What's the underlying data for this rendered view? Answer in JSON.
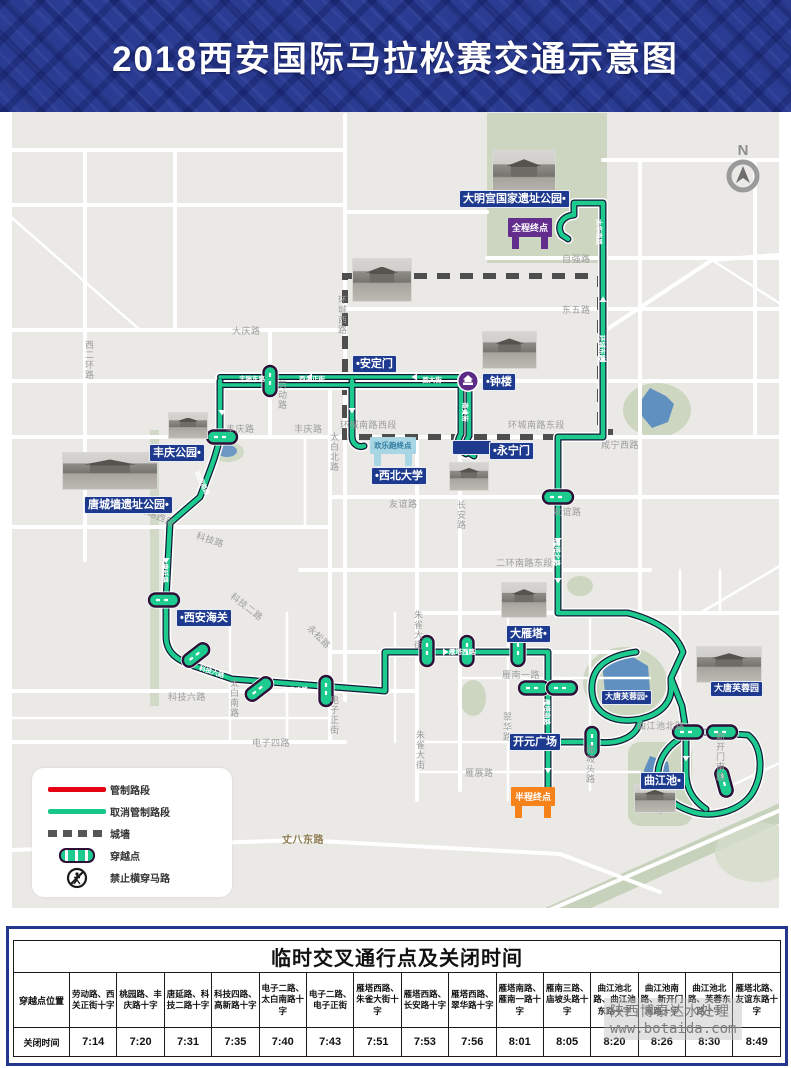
{
  "header": {
    "title": "2018西安国际马拉松赛交通示意图"
  },
  "north_label": "N",
  "map": {
    "place_labels": [
      {
        "id": "damingong",
        "text": "大明宫国家遗址公园•"
      },
      {
        "id": "andingmen",
        "text": "•安定门"
      },
      {
        "id": "zhonglou",
        "text": "•钟楼"
      },
      {
        "id": "yongningmen",
        "text": "•永宁门"
      },
      {
        "id": "fengqing",
        "text": "丰庆公园•"
      },
      {
        "id": "tangcheng",
        "text": "唐城墙遗址公园•"
      },
      {
        "id": "haiguan",
        "text": "•西安海关"
      },
      {
        "id": "xibeidaxue",
        "text": "•西北大学"
      },
      {
        "id": "dayanta",
        "text": "大雁塔•"
      },
      {
        "id": "kaiyuan",
        "text": "开元广场"
      },
      {
        "id": "datangfurong-small",
        "text": "大唐芙蓉园•"
      },
      {
        "id": "datangfurong",
        "text": "大唐芙蓉园"
      },
      {
        "id": "qujiangchi",
        "text": "曲江池•"
      }
    ],
    "gates": {
      "full_finish": "全程终点",
      "half_finish": "半程终点",
      "fun_run_finish": "欢乐跑终点"
    },
    "road_labels": [
      {
        "text": "大庆路"
      },
      {
        "text": "西二环路"
      },
      {
        "text": "环城西路"
      },
      {
        "text": "自强路"
      },
      {
        "text": "东五路"
      },
      {
        "text": "环城南路西段"
      },
      {
        "text": "环城南路东段"
      },
      {
        "text": "咸宁西路"
      },
      {
        "text": "丰庆路"
      },
      {
        "text": "丰庆路"
      },
      {
        "text": "太白北路"
      },
      {
        "text": "劳动路"
      },
      {
        "text": "友谊路"
      },
      {
        "text": "友谊路"
      },
      {
        "text": "长安路"
      },
      {
        "text": "二环南路西段"
      },
      {
        "text": "二环南路东段"
      },
      {
        "text": "科技路"
      },
      {
        "text": "科技二路"
      },
      {
        "text": "科技六路"
      },
      {
        "text": "电子四路"
      },
      {
        "text": "电子正街"
      },
      {
        "text": "朱雀大街"
      },
      {
        "text": "朱雀大街"
      },
      {
        "text": "太白南路"
      },
      {
        "text": "永松路"
      },
      {
        "text": "翠华路"
      },
      {
        "text": "雁南一路"
      },
      {
        "text": "雁展路"
      },
      {
        "text": "曲江池北路"
      },
      {
        "text": "新开门南路"
      },
      {
        "text": "庙坡头路"
      },
      {
        "text": "丈八东路"
      }
    ],
    "route_labels": [
      {
        "text": "丰镐东路"
      },
      {
        "text": "西大街"
      },
      {
        "text": "南大街"
      },
      {
        "text": "桃园南路"
      },
      {
        "text": "唐延路"
      },
      {
        "text": "科技六路"
      },
      {
        "text": "电子二路"
      },
      {
        "text": "雁塔西路"
      },
      {
        "text": "雁塔北路"
      },
      {
        "text": "环城东路"
      },
      {
        "text": "太华南路"
      },
      {
        "text": "雁塔南路"
      },
      {
        "text": "西关正街"
      }
    ]
  },
  "legend": {
    "items": [
      {
        "label": "管制路段"
      },
      {
        "label": "取消管制路段"
      },
      {
        "label": "城墙"
      },
      {
        "label": "穿越点"
      },
      {
        "label": "禁止横穿马路"
      }
    ]
  },
  "table": {
    "title": "临时交叉通行点及关闭时间",
    "row1_label": "穿越点位置",
    "row2_label": "关闭时间",
    "columns": [
      {
        "location": "劳动路、西关正街十字",
        "time": "7:14"
      },
      {
        "location": "桃园路、丰庆路十字",
        "time": "7:20"
      },
      {
        "location": "唐延路、科技二路十字",
        "time": "7:31"
      },
      {
        "location": "科技四路、高新路十字",
        "time": "7:35"
      },
      {
        "location": "电子二路、太白南路十字",
        "time": "7:40"
      },
      {
        "location": "电子二路、电子正街",
        "time": "7:43"
      },
      {
        "location": "雁塔西路、朱雀大街十字",
        "time": "7:51"
      },
      {
        "location": "雁塔西路、长安路十字",
        "time": "7:53"
      },
      {
        "location": "雁塔西路、翠华路十字",
        "time": "7:56"
      },
      {
        "location": "雁塔南路、雁南一路十字",
        "time": "8:01"
      },
      {
        "location": "雁南三路、庙坡头路十字",
        "time": "8:05"
      },
      {
        "location": "曲江池北路、曲江池东路十字",
        "time": "8:20"
      },
      {
        "location": "曲江池南路、新开门南路十字",
        "time": "8:26"
      },
      {
        "location": "曲江池北路、芙蓉东路十字",
        "time": "8:30"
      },
      {
        "location": "雁塔北路、友谊东路十字",
        "time": "8:49"
      }
    ]
  },
  "watermark": {
    "line1": "陕西博泰达水处理",
    "line2": "www.botaida.com"
  }
}
